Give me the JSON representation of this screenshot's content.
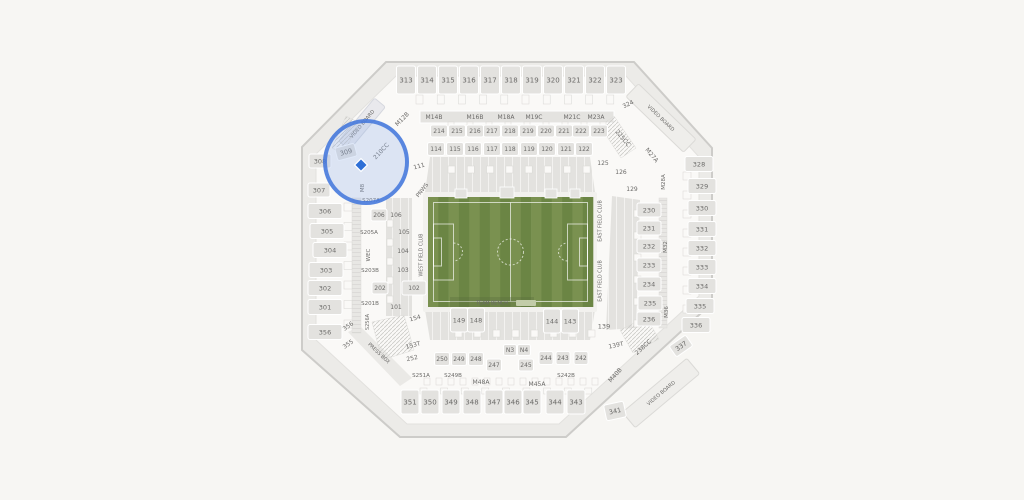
{
  "app": {
    "name": "stadium-seat-map"
  },
  "colors": {
    "page_bg": "#F7F6F3",
    "stadium_fill": "#ECEBE8",
    "stadium_stroke": "#CDCCC9",
    "bowl_fill": "#FAF9F7",
    "section_fill": "#E3E2DF",
    "section_stroke": "#FFFFFF",
    "label_color": "#6B6A68",
    "strip_fill": "#EFEEEB",
    "field_light": "#7A9150",
    "field_dark": "#6B8544",
    "pitch_line": "#FFFFFF",
    "highlight_ring": "#4679DC",
    "highlight_tint": "#8FB0E8",
    "seat_marker": "#2E6FD6"
  },
  "map": {
    "sections": [
      {
        "t": "313",
        "x": 406,
        "y": 80,
        "w": 19,
        "h": 28,
        "fs": 7
      },
      {
        "t": "314",
        "x": 427,
        "y": 80,
        "w": 19,
        "h": 28,
        "fs": 7
      },
      {
        "t": "315",
        "x": 448,
        "y": 80,
        "w": 19,
        "h": 28,
        "fs": 7
      },
      {
        "t": "316",
        "x": 469,
        "y": 80,
        "w": 19,
        "h": 28,
        "fs": 7
      },
      {
        "t": "317",
        "x": 490,
        "y": 80,
        "w": 19,
        "h": 28,
        "fs": 7
      },
      {
        "t": "318",
        "x": 511,
        "y": 80,
        "w": 19,
        "h": 28,
        "fs": 7
      },
      {
        "t": "319",
        "x": 532,
        "y": 80,
        "w": 19,
        "h": 28,
        "fs": 7
      },
      {
        "t": "320",
        "x": 553,
        "y": 80,
        "w": 19,
        "h": 28,
        "fs": 7
      },
      {
        "t": "321",
        "x": 574,
        "y": 80,
        "w": 19,
        "h": 28,
        "fs": 7
      },
      {
        "t": "322",
        "x": 595,
        "y": 80,
        "w": 19,
        "h": 28,
        "fs": 7
      },
      {
        "t": "323",
        "x": 616,
        "y": 80,
        "w": 19,
        "h": 28,
        "fs": 7
      },
      {
        "t": "324",
        "x": 628,
        "y": 104,
        "r": -25,
        "fs": 6
      },
      {
        "t": "M12B",
        "x": 402,
        "y": 119,
        "r": -45,
        "fs": 6
      },
      {
        "t": "M14B",
        "x": 434,
        "y": 117,
        "fs": 6
      },
      {
        "t": "M16B",
        "x": 475,
        "y": 117,
        "fs": 6
      },
      {
        "t": "M18A",
        "x": 506,
        "y": 117,
        "fs": 6
      },
      {
        "t": "M19C",
        "x": 534,
        "y": 117,
        "fs": 6
      },
      {
        "t": "M21C",
        "x": 572,
        "y": 117,
        "fs": 6
      },
      {
        "t": "M23A",
        "x": 596,
        "y": 117,
        "fs": 6
      },
      {
        "t": "214",
        "x": 439,
        "y": 131,
        "w": 17,
        "h": 12,
        "fs": 6
      },
      {
        "t": "215",
        "x": 457,
        "y": 131,
        "w": 17,
        "h": 12,
        "fs": 6
      },
      {
        "t": "216",
        "x": 475,
        "y": 131,
        "w": 17,
        "h": 12,
        "fs": 6
      },
      {
        "t": "217",
        "x": 492,
        "y": 131,
        "w": 17,
        "h": 12,
        "fs": 6
      },
      {
        "t": "218",
        "x": 510,
        "y": 131,
        "w": 17,
        "h": 12,
        "fs": 6
      },
      {
        "t": "219",
        "x": 528,
        "y": 131,
        "w": 17,
        "h": 12,
        "fs": 6
      },
      {
        "t": "220",
        "x": 546,
        "y": 131,
        "w": 17,
        "h": 12,
        "fs": 6
      },
      {
        "t": "221",
        "x": 564,
        "y": 131,
        "w": 17,
        "h": 12,
        "fs": 6
      },
      {
        "t": "222",
        "x": 581,
        "y": 131,
        "w": 17,
        "h": 12,
        "fs": 6
      },
      {
        "t": "223",
        "x": 599,
        "y": 131,
        "w": 17,
        "h": 12,
        "fs": 6
      },
      {
        "t": "114",
        "x": 436,
        "y": 149,
        "w": 17,
        "h": 13,
        "fs": 6
      },
      {
        "t": "115",
        "x": 455,
        "y": 149,
        "w": 17,
        "h": 13,
        "fs": 6
      },
      {
        "t": "116",
        "x": 473,
        "y": 149,
        "w": 17,
        "h": 13,
        "fs": 6
      },
      {
        "t": "117",
        "x": 492,
        "y": 149,
        "w": 17,
        "h": 13,
        "fs": 6
      },
      {
        "t": "118",
        "x": 510,
        "y": 149,
        "w": 17,
        "h": 13,
        "fs": 6
      },
      {
        "t": "119",
        "x": 529,
        "y": 149,
        "w": 17,
        "h": 13,
        "fs": 6
      },
      {
        "t": "120",
        "x": 547,
        "y": 149,
        "w": 17,
        "h": 13,
        "fs": 6
      },
      {
        "t": "121",
        "x": 566,
        "y": 149,
        "w": 17,
        "h": 13,
        "fs": 6
      },
      {
        "t": "122",
        "x": 584,
        "y": 149,
        "w": 17,
        "h": 13,
        "fs": 6
      },
      {
        "t": "111",
        "x": 419,
        "y": 166,
        "r": -15,
        "fs": 6
      },
      {
        "t": "125",
        "x": 603,
        "y": 163,
        "fs": 6
      },
      {
        "t": "126",
        "x": 621,
        "y": 172,
        "fs": 6
      },
      {
        "t": "129",
        "x": 632,
        "y": 189,
        "fs": 6
      },
      {
        "t": "VIDEO BOARD",
        "x": 661,
        "y": 118,
        "r": 44,
        "fs": 5,
        "ia": false
      },
      {
        "t": "225CC",
        "x": 623,
        "y": 138,
        "r": 50,
        "fs": 6
      },
      {
        "t": "M27A",
        "x": 652,
        "y": 155,
        "r": 50,
        "fs": 6
      },
      {
        "t": "M28A",
        "x": 663,
        "y": 182,
        "r": -90,
        "fs": 5.5
      },
      {
        "t": "M32",
        "x": 665,
        "y": 247,
        "r": -90,
        "fs": 5.5
      },
      {
        "t": "M36",
        "x": 666,
        "y": 312,
        "r": -90,
        "fs": 5.5
      },
      {
        "t": "328",
        "x": 699,
        "y": 164,
        "w": 28,
        "h": 15
      },
      {
        "t": "329",
        "x": 702,
        "y": 186,
        "w": 28,
        "h": 15
      },
      {
        "t": "330",
        "x": 702,
        "y": 208,
        "w": 28,
        "h": 15
      },
      {
        "t": "331",
        "x": 702,
        "y": 229,
        "w": 28,
        "h": 15
      },
      {
        "t": "332",
        "x": 702,
        "y": 248,
        "w": 28,
        "h": 15
      },
      {
        "t": "333",
        "x": 702,
        "y": 267,
        "w": 28,
        "h": 15
      },
      {
        "t": "334",
        "x": 702,
        "y": 286,
        "w": 28,
        "h": 15
      },
      {
        "t": "335",
        "x": 700,
        "y": 306,
        "w": 28,
        "h": 15
      },
      {
        "t": "336",
        "x": 696,
        "y": 325,
        "w": 28,
        "h": 15
      },
      {
        "t": "337",
        "x": 681,
        "y": 346,
        "w": 20,
        "h": 13,
        "r": -35
      },
      {
        "t": "230",
        "x": 649,
        "y": 210,
        "w": 24,
        "h": 14
      },
      {
        "t": "231",
        "x": 649,
        "y": 228,
        "w": 24,
        "h": 14
      },
      {
        "t": "232",
        "x": 649,
        "y": 246,
        "w": 24,
        "h": 14
      },
      {
        "t": "233",
        "x": 649,
        "y": 265,
        "w": 24,
        "h": 14
      },
      {
        "t": "234",
        "x": 649,
        "y": 284,
        "w": 24,
        "h": 14
      },
      {
        "t": "235",
        "x": 650,
        "y": 303,
        "w": 24,
        "h": 14
      },
      {
        "t": "236",
        "x": 649,
        "y": 319,
        "w": 24,
        "h": 14
      },
      {
        "t": "EAST FIELD CLUB",
        "x": 600,
        "y": 221,
        "r": -90,
        "fs": 4.8,
        "ia": false
      },
      {
        "t": "EAST FIELD CLUB",
        "x": 600,
        "y": 281,
        "r": -90,
        "fs": 4.8,
        "ia": false
      },
      {
        "t": "139",
        "x": 604,
        "y": 326,
        "fs": 6.5
      },
      {
        "t": "139T",
        "x": 616,
        "y": 345,
        "r": -12,
        "fs": 6
      },
      {
        "t": "238CC",
        "x": 643,
        "y": 347,
        "r": -42,
        "fs": 6
      },
      {
        "t": "M40B",
        "x": 615,
        "y": 375,
        "r": -48,
        "fs": 6
      },
      {
        "t": "VIDEO BOARD",
        "x": 661,
        "y": 393,
        "r": -40,
        "fs": 5,
        "ia": false
      },
      {
        "t": "341",
        "x": 615,
        "y": 411,
        "w": 20,
        "h": 16,
        "r": -12
      },
      {
        "t": "VIDEO BOARD",
        "x": 362,
        "y": 124,
        "r": -50,
        "fs": 5,
        "ia": false
      },
      {
        "t": "210CC",
        "x": 381,
        "y": 151,
        "r": -47,
        "fs": 6
      },
      {
        "t": "309",
        "x": 346,
        "y": 152,
        "w": 20,
        "h": 13,
        "r": -15
      },
      {
        "t": "308",
        "x": 320,
        "y": 161,
        "w": 22,
        "h": 14
      },
      {
        "t": "307",
        "x": 319,
        "y": 190,
        "w": 22,
        "h": 14
      },
      {
        "t": "M8",
        "x": 362,
        "y": 188,
        "r": -90,
        "fs": 5.5
      },
      {
        "t": "S207A",
        "x": 371,
        "y": 200,
        "fs": 5.5
      },
      {
        "t": "306",
        "x": 325,
        "y": 211,
        "w": 34,
        "h": 15
      },
      {
        "t": "305",
        "x": 327,
        "y": 231,
        "w": 34,
        "h": 15
      },
      {
        "t": "304",
        "x": 330,
        "y": 250,
        "w": 34,
        "h": 15
      },
      {
        "t": "303",
        "x": 326,
        "y": 270,
        "w": 34,
        "h": 15
      },
      {
        "t": "302",
        "x": 325,
        "y": 288,
        "w": 34,
        "h": 15
      },
      {
        "t": "301",
        "x": 325,
        "y": 307,
        "w": 34,
        "h": 15
      },
      {
        "t": "356",
        "x": 325,
        "y": 332,
        "w": 34,
        "h": 15
      },
      {
        "t": "356",
        "x": 348,
        "y": 326,
        "r": -35,
        "fs": 6
      },
      {
        "t": "355",
        "x": 348,
        "y": 344,
        "r": -35,
        "fs": 6
      },
      {
        "t": "206",
        "x": 379,
        "y": 215,
        "w": 16,
        "h": 12,
        "fs": 6
      },
      {
        "t": "202",
        "x": 380,
        "y": 288,
        "w": 16,
        "h": 12,
        "fs": 6
      },
      {
        "t": "S205A",
        "x": 369,
        "y": 232,
        "fs": 5.5
      },
      {
        "t": "S203B",
        "x": 370,
        "y": 270,
        "fs": 5.5
      },
      {
        "t": "S201B",
        "x": 370,
        "y": 303,
        "fs": 5.5
      },
      {
        "t": "WEC",
        "x": 368,
        "y": 255,
        "r": -90,
        "fs": 5.5
      },
      {
        "t": "S256A",
        "x": 367,
        "y": 322,
        "r": -90,
        "fs": 5
      },
      {
        "t": "106",
        "x": 396,
        "y": 215,
        "fs": 6
      },
      {
        "t": "105",
        "x": 404,
        "y": 232,
        "fs": 6
      },
      {
        "t": "104",
        "x": 403,
        "y": 251,
        "fs": 6
      },
      {
        "t": "103",
        "x": 403,
        "y": 270,
        "fs": 6
      },
      {
        "t": "102",
        "x": 414,
        "y": 288,
        "w": 24,
        "h": 14,
        "fs": 6
      },
      {
        "t": "101",
        "x": 396,
        "y": 307,
        "fs": 6
      },
      {
        "t": "154",
        "x": 415,
        "y": 318,
        "r": -15,
        "fs": 6
      },
      {
        "t": "153T",
        "x": 413,
        "y": 345,
        "r": -15,
        "fs": 6
      },
      {
        "t": "252",
        "x": 412,
        "y": 358,
        "r": -12,
        "fs": 6
      },
      {
        "t": "PRESS BOX",
        "x": 379,
        "y": 353,
        "r": 43,
        "fs": 5,
        "ia": false
      },
      {
        "t": "WEST FIELD CLUB",
        "x": 421,
        "y": 255,
        "r": -90,
        "fs": 4.8,
        "ia": false
      },
      {
        "t": "PNWS",
        "x": 422,
        "y": 190,
        "r": -52,
        "fs": 5.5,
        "ia": false
      },
      {
        "t": "TEAM BENCH",
        "x": 492,
        "y": 303,
        "fs": 4.8,
        "ia": false
      },
      {
        "t": "149",
        "x": 459,
        "y": 320,
        "w": 17,
        "h": 24
      },
      {
        "t": "148",
        "x": 476,
        "y": 320,
        "w": 17,
        "h": 24
      },
      {
        "t": "144",
        "x": 552,
        "y": 321,
        "w": 17,
        "h": 24
      },
      {
        "t": "143",
        "x": 570,
        "y": 321,
        "w": 17,
        "h": 24
      },
      {
        "t": "N3",
        "x": 510,
        "y": 350,
        "w": 13,
        "h": 11,
        "fs": 6
      },
      {
        "t": "N4",
        "x": 524,
        "y": 350,
        "w": 13,
        "h": 11,
        "fs": 6
      },
      {
        "t": "250",
        "x": 442,
        "y": 359,
        "w": 15,
        "h": 13,
        "fs": 6
      },
      {
        "t": "249",
        "x": 459,
        "y": 359,
        "w": 15,
        "h": 13,
        "fs": 6
      },
      {
        "t": "248",
        "x": 476,
        "y": 359,
        "w": 15,
        "h": 13,
        "fs": 6
      },
      {
        "t": "247",
        "x": 494,
        "y": 365,
        "w": 15,
        "h": 12,
        "fs": 6
      },
      {
        "t": "245",
        "x": 526,
        "y": 365,
        "w": 15,
        "h": 12,
        "fs": 6
      },
      {
        "t": "244",
        "x": 546,
        "y": 358,
        "w": 14,
        "h": 13,
        "fs": 6
      },
      {
        "t": "243",
        "x": 563,
        "y": 358,
        "w": 14,
        "h": 13,
        "fs": 6
      },
      {
        "t": "242",
        "x": 581,
        "y": 358,
        "w": 14,
        "h": 13,
        "fs": 6
      },
      {
        "t": "S251A",
        "x": 421,
        "y": 375,
        "fs": 5.5
      },
      {
        "t": "S249B",
        "x": 453,
        "y": 375,
        "fs": 5.5
      },
      {
        "t": "S242B",
        "x": 566,
        "y": 375,
        "fs": 5.5
      },
      {
        "t": "M48A",
        "x": 481,
        "y": 382,
        "fs": 6
      },
      {
        "t": "M45A",
        "x": 537,
        "y": 384,
        "fs": 6
      },
      {
        "t": "351",
        "x": 410,
        "y": 402,
        "w": 18,
        "h": 24,
        "fs": 7
      },
      {
        "t": "350",
        "x": 430,
        "y": 402,
        "w": 18,
        "h": 24,
        "fs": 7
      },
      {
        "t": "349",
        "x": 451,
        "y": 402,
        "w": 18,
        "h": 24,
        "fs": 7
      },
      {
        "t": "348",
        "x": 472,
        "y": 402,
        "w": 18,
        "h": 24,
        "fs": 7
      },
      {
        "t": "347",
        "x": 494,
        "y": 402,
        "w": 18,
        "h": 24,
        "fs": 7
      },
      {
        "t": "346",
        "x": 513,
        "y": 402,
        "w": 18,
        "h": 24,
        "fs": 7
      },
      {
        "t": "345",
        "x": 532,
        "y": 402,
        "w": 18,
        "h": 24,
        "fs": 7
      },
      {
        "t": "344",
        "x": 555,
        "y": 402,
        "w": 18,
        "h": 24,
        "fs": 7
      },
      {
        "t": "343",
        "x": 576,
        "y": 402,
        "w": 18,
        "h": 24,
        "fs": 7
      }
    ],
    "highlight": {
      "selected_section": "309",
      "marker": "seat-marker"
    }
  }
}
